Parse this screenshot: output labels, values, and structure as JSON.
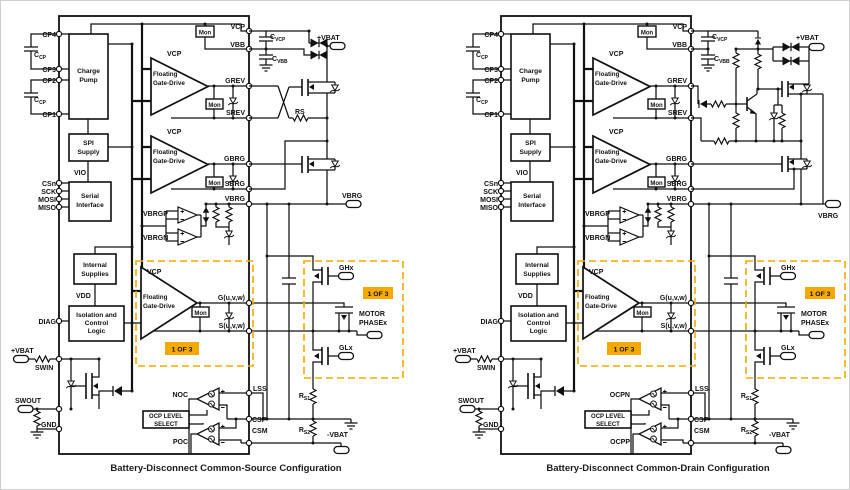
{
  "colors": {
    "ink": "#111111",
    "orange": "#f5a800",
    "border": "#cfcfcf"
  },
  "pins": {
    "cp4": "CP4",
    "cp3": "CP3",
    "cp2": "CP2",
    "cp1": "CP1",
    "csn": "CSn",
    "sck": "SCK",
    "mosi": "MOSI",
    "miso": "MISO",
    "diag": "DIAG",
    "swin": "SWIN",
    "swout": "SWOUT",
    "gnd": "GND",
    "vcp": "VCP",
    "vbb": "VBB",
    "grev": "GREV",
    "srev": "SREV",
    "gbrg": "GBRG",
    "sbrg": "SBRG",
    "vbrg": "VBRG",
    "guvw": "G(u,v,w)",
    "suvw": "S(u,v,w)",
    "lss": "LSS",
    "csp": "CSP",
    "csm": "CSM"
  },
  "blocks": {
    "charge_pump": [
      "Charge",
      "Pump"
    ],
    "spi_supply": [
      "SPI",
      "Supply"
    ],
    "serial_interface": [
      "Serial",
      "Interface"
    ],
    "internal_supplies": [
      "Internal",
      "Supplies"
    ],
    "isolation": [
      "Isolation and",
      "Control",
      "Logic"
    ],
    "ocp": [
      "OCP LEVEL",
      "SELECT"
    ]
  },
  "nets": {
    "vio": "VIO",
    "vdd": "VDD",
    "vcp": "VCP",
    "vbrgp": "VBRGP",
    "vbrgn": "VBRGN",
    "mon": "Mon",
    "gd1": "Floating",
    "gd2": "Gate-Drive",
    "one_of_3": "1 OF 3"
  },
  "ext": {
    "c": "C",
    "cp": "CP",
    "vcp": "VCP",
    "vbb": "VBB",
    "r": "R",
    "s1": "S1",
    "s2": "S2",
    "rs": "RS",
    "pvbat": "+VBAT",
    "nvbat": "-VBAT",
    "vbrg": "VBRG",
    "ghx": "GHx",
    "glx": "GLx",
    "motor": "MOTOR",
    "phasex": "PHASEx"
  },
  "left": {
    "ocp_top": "NOC",
    "ocp_bottom": "POC",
    "caption": "Battery-Disconnect Common-Source Configuration"
  },
  "right": {
    "ocp_top": "OCPN",
    "ocp_bottom": "OCPP",
    "caption": "Battery-Disconnect Common-Drain Configuration"
  }
}
